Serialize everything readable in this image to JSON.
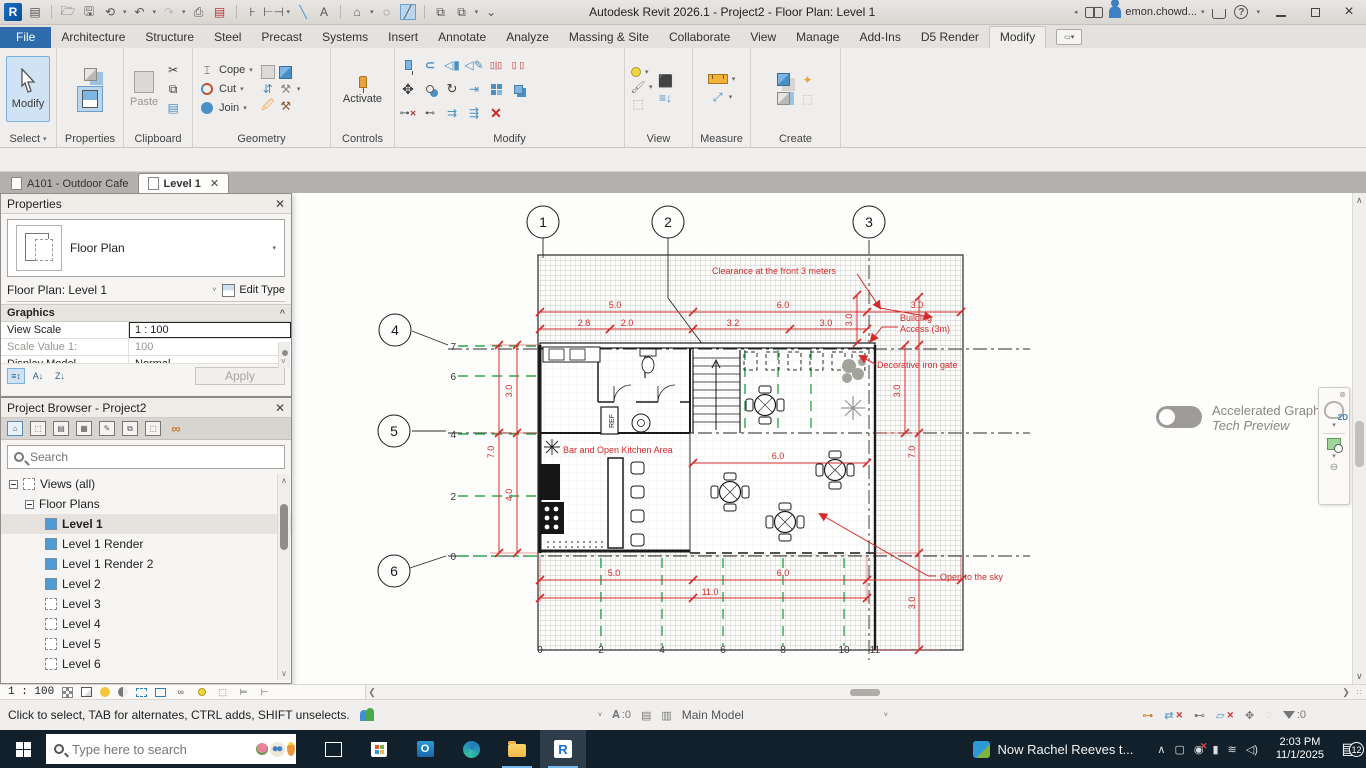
{
  "titlebar": {
    "title": "Autodesk Revit 2026.1 - Project2 - Floor Plan: Level 1",
    "user": "emon.chowd..."
  },
  "ribbon": {
    "tabs": [
      "File",
      "Architecture",
      "Structure",
      "Steel",
      "Precast",
      "Systems",
      "Insert",
      "Annotate",
      "Analyze",
      "Massing & Site",
      "Collaborate",
      "View",
      "Manage",
      "Add-Ins",
      "D5 Render",
      "Modify"
    ],
    "active_tab": "Modify",
    "panel_labels": [
      "Select",
      "Properties",
      "Clipboard",
      "Geometry",
      "Controls",
      "Modify",
      "View",
      "Measure",
      "Create"
    ],
    "buttons": {
      "modify": "Modify",
      "paste": "Paste",
      "cope": "Cope",
      "cut": "Cut",
      "join": "Join",
      "activate": "Activate"
    }
  },
  "view_tabs": {
    "tab1": "A101 - Outdoor Cafe",
    "tab2": "Level 1"
  },
  "properties": {
    "title": "Properties",
    "type_name": "Floor Plan",
    "instance": "Floor Plan: Level 1",
    "edit_type": "Edit Type",
    "section": "Graphics",
    "rows": [
      {
        "label": "View Scale",
        "value": "1 : 100"
      },
      {
        "label": "Scale Value    1:",
        "value": "100"
      },
      {
        "label": "Display Model",
        "value": "Normal"
      }
    ],
    "apply": "Apply"
  },
  "browser": {
    "title": "Project Browser - Project2",
    "search_placeholder": "Search",
    "root": "Views (all)",
    "group": "Floor Plans",
    "items": [
      "Level 1",
      "Level 1 Render",
      "Level 1 Render 2",
      "Level 2",
      "Level 3",
      "Level 4",
      "Level 5",
      "Level 6"
    ]
  },
  "plan": {
    "grid_bubbles": [
      "1",
      "2",
      "3",
      "4",
      "5",
      "6"
    ],
    "left_ruler": [
      "7",
      "6",
      "4",
      "2",
      "0"
    ],
    "bottom_ruler": [
      "0",
      "2",
      "4",
      "6",
      "8",
      "10",
      "11"
    ],
    "dims": {
      "top_row1": [
        "5.0",
        "6.0",
        "3.0"
      ],
      "top_row2": [
        "2.8",
        "2.0",
        "3.2",
        "3.0"
      ],
      "top_vert": "3.0",
      "left_outer": "7.0",
      "left_inner": [
        "3.0",
        "4.0"
      ],
      "right_inner": "3.0",
      "right_outer": [
        "7.0",
        "3.0"
      ],
      "bottom_row1": [
        "5.0",
        "6.0"
      ],
      "bottom_total": "11.0",
      "courtyard": "6.0"
    },
    "annotations": {
      "clearance": "Clearance at the front 3 meters",
      "building_access_1": "Building",
      "building_access_2": "Access (3m)",
      "gate": "Decorative iron gate",
      "bar": "Bar and Open Kitchen Area",
      "sky": "Open to the sky",
      "ref": "REF"
    },
    "colors": {
      "dimension_red": "#d42a2a",
      "grid_green": "#2fa84f"
    }
  },
  "right_panel": {
    "accel_title": "Accelerated Graphics",
    "accel_sub": "Tech Preview",
    "nav_2d": "2D"
  },
  "status": {
    "hint": "Click to select, TAB for alternates, CTRL adds, SHIFT unselects.",
    "editable_count": ":0",
    "workset": "Main Model",
    "filter_count": ":0",
    "view_scale": "1 : 100"
  },
  "taskbar": {
    "search_placeholder": "Type here to search",
    "news": "Now Rachel Reeves t...",
    "time": "2:03 PM",
    "date": "11/1/2025",
    "badge": "12"
  }
}
